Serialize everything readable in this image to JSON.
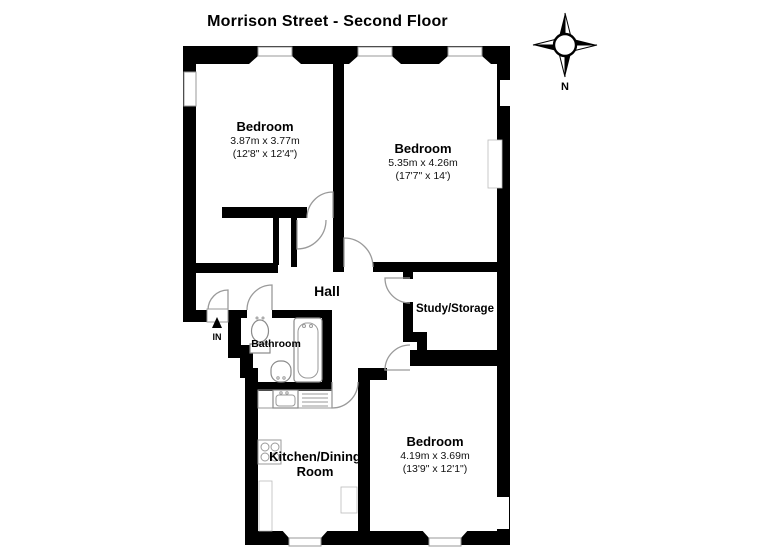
{
  "title": "Morrison Street - Second Floor",
  "compass": {
    "north_label": "N"
  },
  "entrance": {
    "label": "IN"
  },
  "rooms": {
    "bedroom_top_left": {
      "name": "Bedroom",
      "dims_metric": "3.87m x 3.77m",
      "dims_imperial": "(12'8\" x 12'4\")"
    },
    "bedroom_top_right": {
      "name": "Bedroom",
      "dims_metric": "5.35m x 4.26m",
      "dims_imperial": "(17'7\" x 14')"
    },
    "bedroom_bottom": {
      "name": "Bedroom",
      "dims_metric": "4.19m x 3.69m",
      "dims_imperial": "(13'9\" x 12'1\")"
    },
    "hall": {
      "name": "Hall"
    },
    "study": {
      "name": "Study/Storage"
    },
    "bathroom": {
      "name": "Bathroom"
    },
    "kitchen": {
      "line1": "Kitchen/Dining",
      "line2": "Room"
    }
  },
  "colors": {
    "wall": "#000000",
    "background": "#ffffff",
    "fixture_outline": "#8a8a8a"
  }
}
